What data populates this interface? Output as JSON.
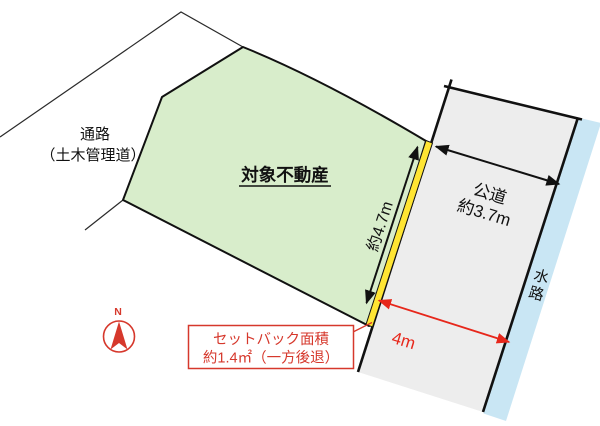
{
  "labels": {
    "passage_1": "通路",
    "passage_2": "（土木管理道）",
    "property": "対象不動産",
    "setback_length": "約4.7m",
    "road_1": "公道",
    "road_2": "約3.7m",
    "water_1": "水",
    "water_2": "路",
    "road_width": "4m",
    "north": "N",
    "callout_1": "セットバック面積",
    "callout_2": "約1.4㎡（一方後退）"
  },
  "colors": {
    "property_green": "#d8edcb",
    "road_gray": "#ededed",
    "water_blue": "#c9e6f4",
    "setback_yellow": "#ffe533",
    "red_accent": "#d6382c",
    "red_arrow": "#e7271b",
    "line_black": "#111111",
    "thin_line": "#2a2a2a"
  }
}
